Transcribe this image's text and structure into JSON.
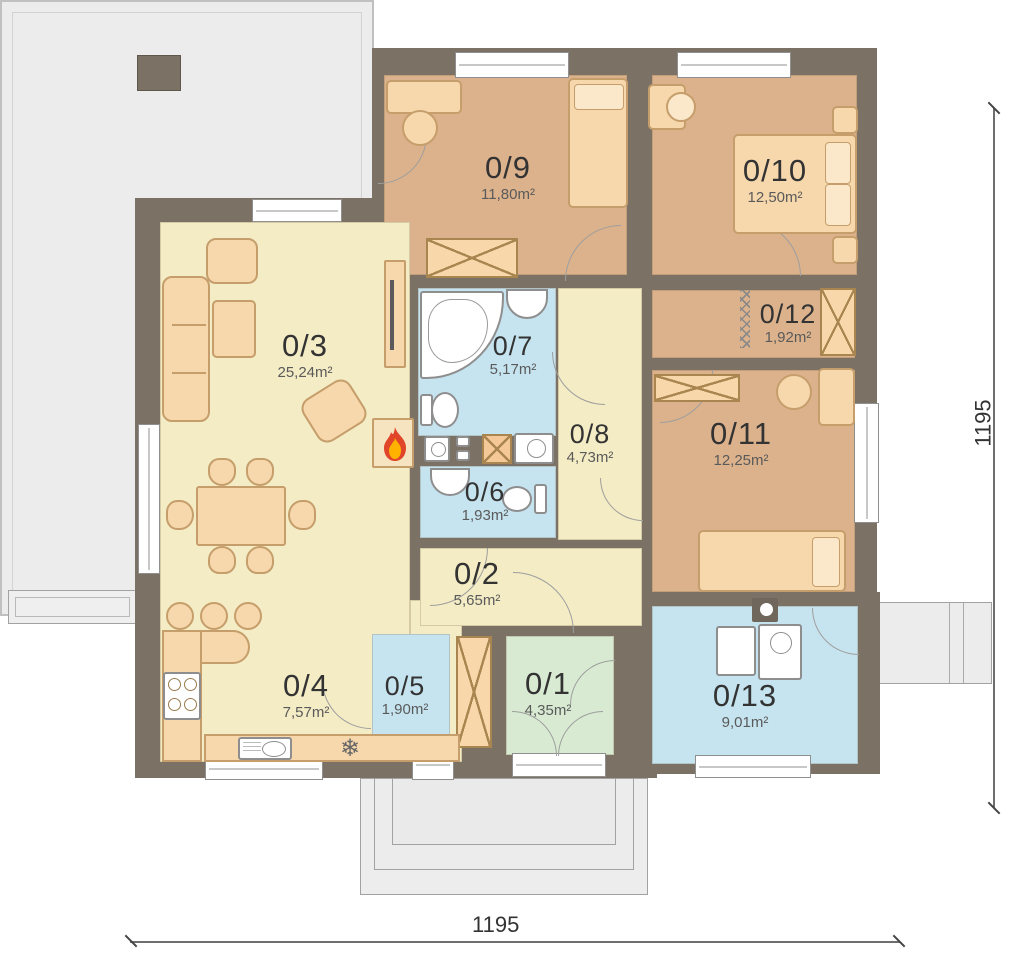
{
  "plan": {
    "rooms": [
      {
        "id": "0/1",
        "area": "4,35m²"
      },
      {
        "id": "0/2",
        "area": "5,65m²"
      },
      {
        "id": "0/3",
        "area": "25,24m²"
      },
      {
        "id": "0/4",
        "area": "7,57m²"
      },
      {
        "id": "0/5",
        "area": "1,90m²"
      },
      {
        "id": "0/6",
        "area": "1,93m²"
      },
      {
        "id": "0/7",
        "area": "5,17m²"
      },
      {
        "id": "0/8",
        "area": "4,73m²"
      },
      {
        "id": "0/9",
        "area": "11,80m²"
      },
      {
        "id": "0/10",
        "area": "12,50m²"
      },
      {
        "id": "0/11",
        "area": "12,25m²"
      },
      {
        "id": "0/12",
        "area": "1,92m²"
      },
      {
        "id": "0/13",
        "area": "9,01m²"
      }
    ],
    "dimensions": {
      "bottom": "1195",
      "right": "1195"
    },
    "icons": {
      "fridge_glyph": "❄",
      "fireplace": "flame"
    },
    "colors": {
      "wall": "#7b7164",
      "room_tan": "#dcb28c",
      "room_cream": "#f4ecc5",
      "room_blue": "#c6e4ef",
      "room_green": "#d8ebd2",
      "furniture": "#f7d8ac",
      "terrace": "#ececec",
      "flame_red": "#e0452a",
      "flame_yellow": "#ffb300"
    }
  }
}
